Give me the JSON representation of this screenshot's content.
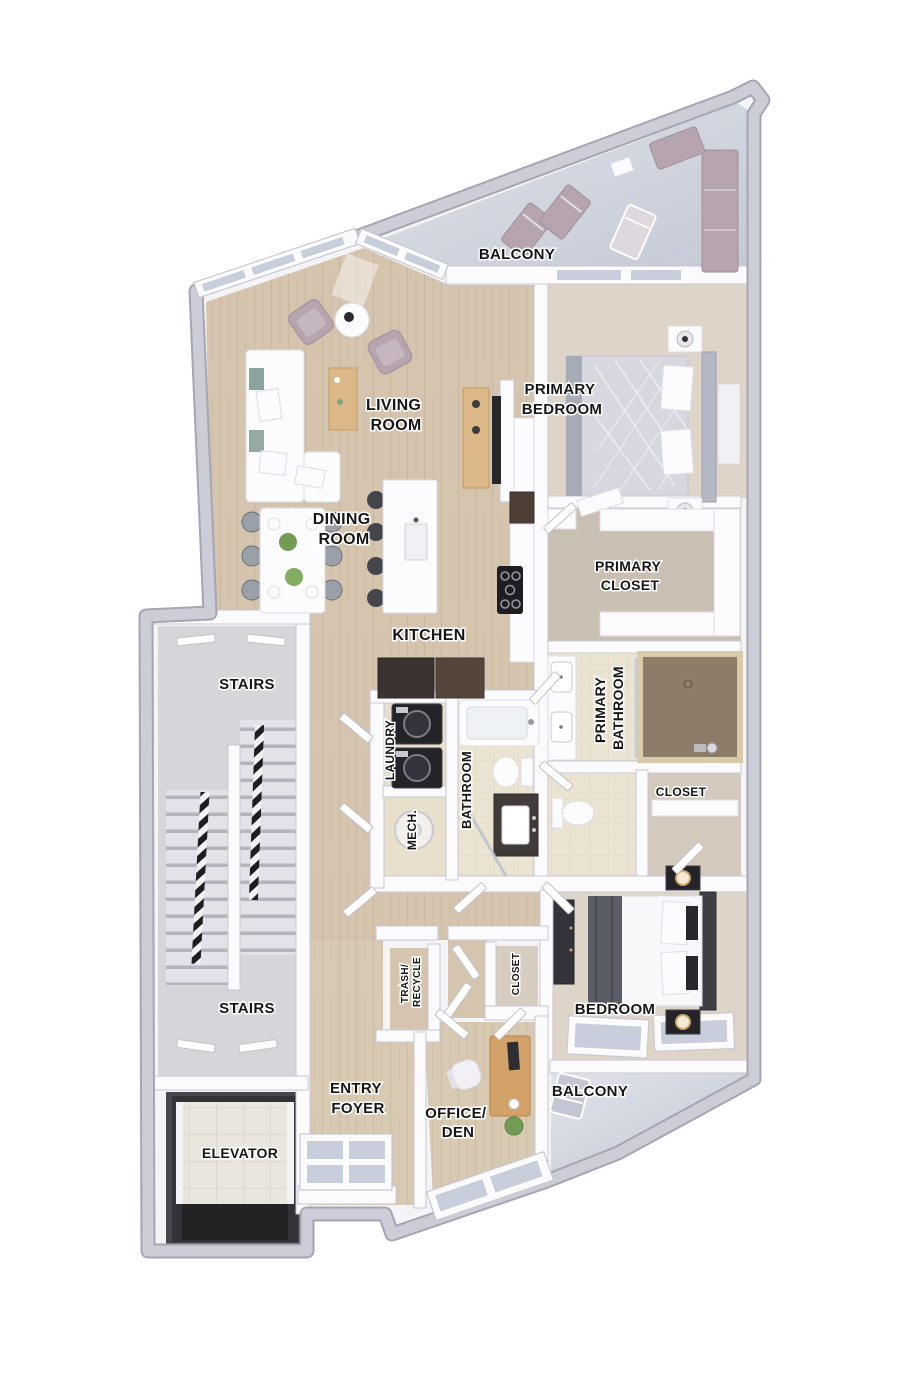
{
  "rooms": {
    "balcony_top": {
      "lines": [
        "BALCONY"
      ]
    },
    "living_room": {
      "lines": [
        "LIVING",
        "ROOM"
      ]
    },
    "primary_bedroom": {
      "lines": [
        "PRIMARY",
        "BEDROOM"
      ]
    },
    "dining_room": {
      "lines": [
        "DINING",
        "ROOM"
      ]
    },
    "kitchen": {
      "lines": [
        "KITCHEN"
      ]
    },
    "primary_closet": {
      "lines": [
        "PRIMARY",
        "CLOSET"
      ]
    },
    "primary_bathroom": {
      "lines": [
        "PRIMARY",
        "BATHROOM"
      ]
    },
    "stairs_upper": {
      "lines": [
        "STAIRS"
      ]
    },
    "stairs_lower": {
      "lines": [
        "STAIRS"
      ]
    },
    "laundry": {
      "lines": [
        "LAUNDRY"
      ]
    },
    "mech": {
      "lines": [
        "MECH."
      ]
    },
    "bathroom": {
      "lines": [
        "BATHROOM"
      ]
    },
    "closet_hall": {
      "lines": [
        "CLOSET"
      ]
    },
    "trash_recycle": {
      "lines": [
        "TRASH/",
        "RECYCLE"
      ]
    },
    "closet_entry": {
      "lines": [
        "CLOSET"
      ]
    },
    "entry_foyer": {
      "lines": [
        "ENTRY",
        "FOYER"
      ]
    },
    "office_den": {
      "lines": [
        "OFFICE/",
        "DEN"
      ]
    },
    "bedroom": {
      "lines": [
        "BEDROOM"
      ]
    },
    "balcony_bottom": {
      "lines": [
        "BALCONY"
      ]
    },
    "elevator": {
      "lines": [
        "ELEVATOR"
      ]
    }
  },
  "palette": {
    "wall_gray": "#c9c9d4",
    "wall_edge": "#a5a5b4",
    "wall_white": "#fbfbfd",
    "wood_floor": "#d5c5ae",
    "bedroom_floor": "#ded5c8",
    "tile_floor": "#ece4d2",
    "closet_floor": "#c9bfb2",
    "balcony_floor": "#cdd1db",
    "stairs_floor": "#d5d5da",
    "shower_tile": "#8d7c67",
    "glass_blue": "#c8cedb",
    "furniture_mauve": "#b6a5af",
    "furniture_dark": "#232328",
    "wood_furniture": "#dcb888",
    "accent_teal": "#8aa39e",
    "elevator_dark": "#38373d",
    "label_color": "#161616"
  }
}
